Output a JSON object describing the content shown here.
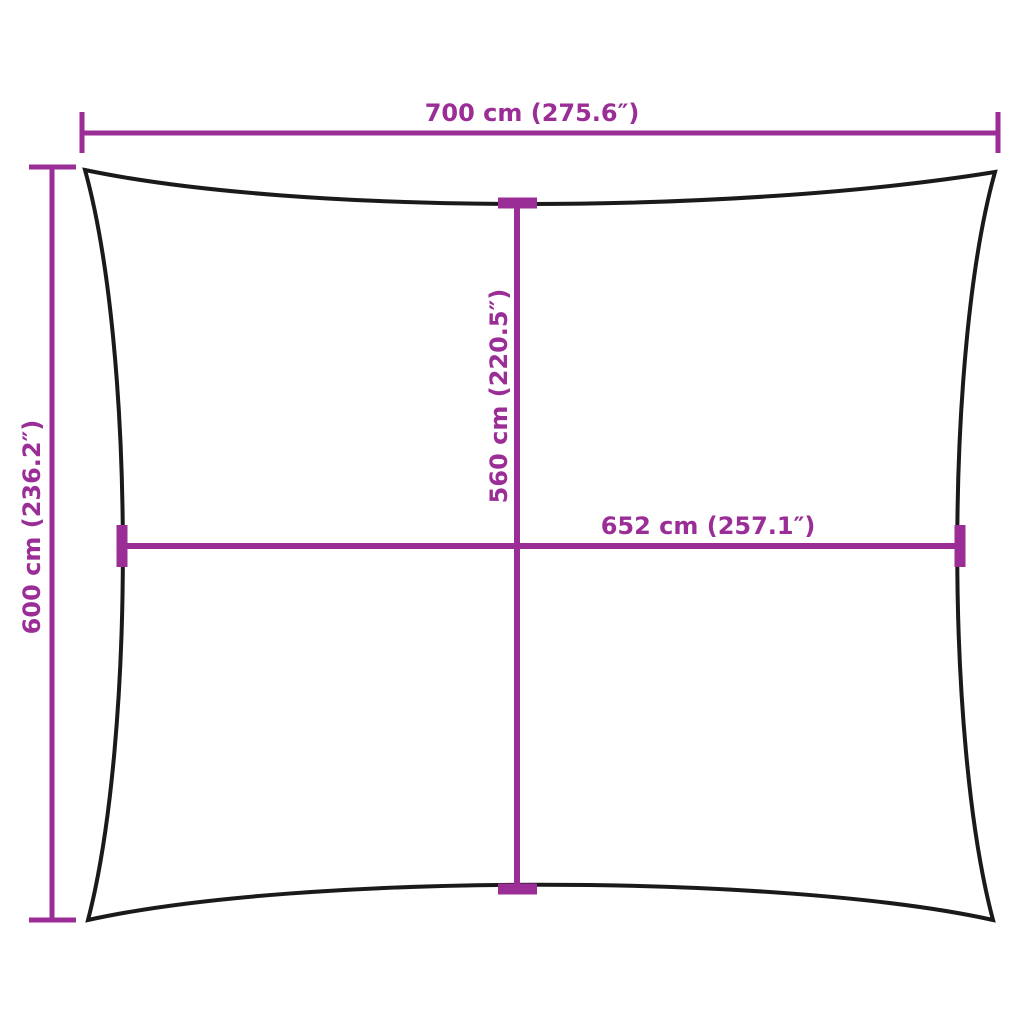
{
  "diagram": {
    "type": "shade-sail-rectangular-dimension-diagram",
    "colors": {
      "dimension": "#9B2D97",
      "outline": "#1a1a1a",
      "background": "#ffffff"
    },
    "dimensions": {
      "outer_width": {
        "label": "700 cm (275.6″)",
        "orientation": "horizontal",
        "position": "top"
      },
      "outer_height": {
        "label": "600 cm (236.2″)",
        "orientation": "vertical",
        "position": "left"
      },
      "inner_height": {
        "label": "560 cm (220.5″)",
        "orientation": "vertical",
        "position": "center"
      },
      "inner_width": {
        "label": "652 cm (257.1″)",
        "orientation": "horizontal",
        "position": "middle"
      }
    }
  }
}
